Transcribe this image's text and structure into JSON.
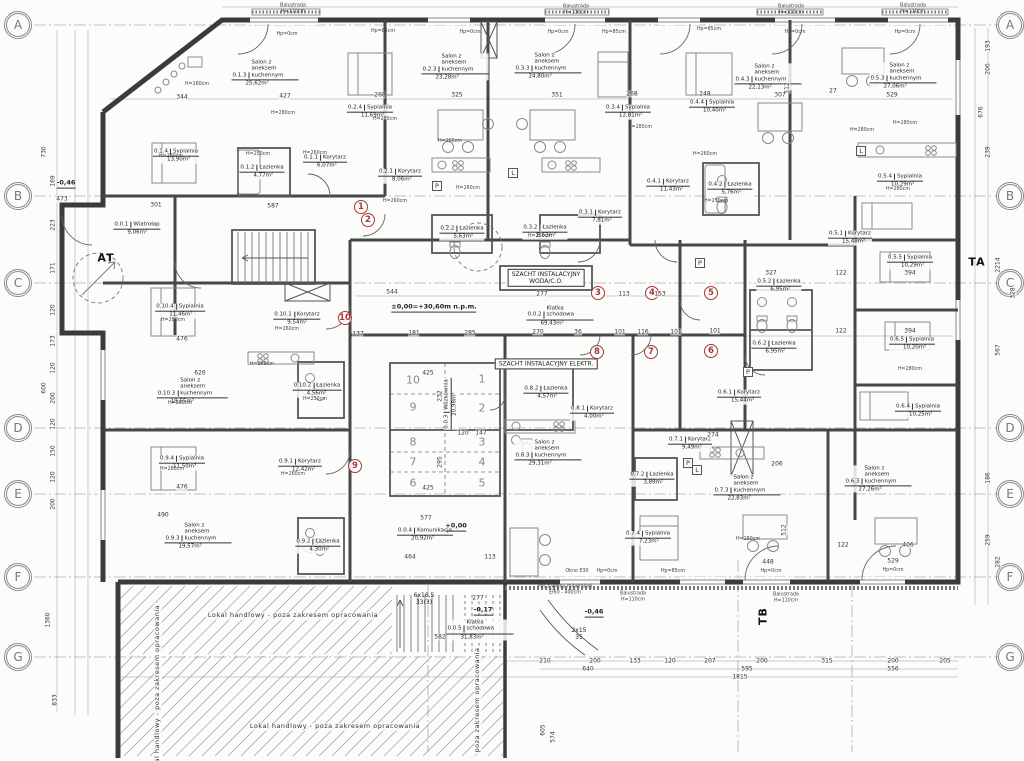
{
  "drawing": {
    "grid": {
      "letters": [
        "A",
        "B",
        "C",
        "D",
        "E",
        "F",
        "G"
      ],
      "ys": [
        25,
        196,
        283,
        428,
        494,
        577,
        657
      ],
      "left_x": 18,
      "right_x": 1010
    },
    "section_labels": [
      {
        "t": "TA",
        "x": 977,
        "y": 262,
        "rot": 0
      },
      {
        "t": "TB",
        "x": 763,
        "y": 616,
        "rot": 1
      },
      {
        "t": "AT",
        "x": 106,
        "y": 258,
        "rot": 0
      }
    ],
    "apartment_markers": [
      {
        "n": "1",
        "x": 361,
        "y": 207
      },
      {
        "n": "2",
        "x": 368,
        "y": 220
      },
      {
        "n": "3",
        "x": 598,
        "y": 293
      },
      {
        "n": "4",
        "x": 652,
        "y": 293
      },
      {
        "n": "5",
        "x": 711,
        "y": 293
      },
      {
        "n": "6",
        "x": 711,
        "y": 351
      },
      {
        "n": "7",
        "x": 651,
        "y": 352
      },
      {
        "n": "8",
        "x": 597,
        "y": 352
      },
      {
        "n": "9",
        "x": 355,
        "y": 466
      },
      {
        "n": "10",
        "x": 345,
        "y": 318
      }
    ],
    "storage_cells": [
      {
        "n": "10",
        "x": 413,
        "y": 380
      },
      {
        "n": "9",
        "x": 413,
        "y": 407
      },
      {
        "n": "8",
        "x": 413,
        "y": 442
      },
      {
        "n": "7",
        "x": 413,
        "y": 462
      },
      {
        "n": "6",
        "x": 413,
        "y": 483
      },
      {
        "n": "1",
        "x": 482,
        "y": 379
      },
      {
        "n": "2",
        "x": 482,
        "y": 408
      },
      {
        "n": "3",
        "x": 482,
        "y": 442
      },
      {
        "n": "4",
        "x": 482,
        "y": 462
      },
      {
        "n": "5",
        "x": 482,
        "y": 483
      }
    ],
    "rooms": [
      [
        "0.0.1",
        "Wiatrołap",
        "9,06m²",
        137,
        229
      ],
      [
        "0.0.2",
        "Klatka schodowa",
        "69,43m²",
        560,
        316
      ],
      [
        "0.0.3",
        "Wózkownia",
        "20,98m²",
        451,
        404
      ],
      [
        "0.0.4",
        "Komunikacja",
        "20,92m²",
        425,
        535
      ],
      [
        "0.0.5",
        "Klatka schodowa",
        "31,83m²",
        480,
        630
      ],
      [
        "0.1.1",
        "Korytarz",
        "6,07m²",
        325,
        162
      ],
      [
        "0.1.2",
        "Łazienka",
        "4,77m²",
        262,
        172
      ],
      [
        "0.1.3",
        "Salon z aneksem kuchennym",
        "25,62m²",
        265,
        73
      ],
      [
        "0.1.4",
        "Sypialnia",
        "13,90m²",
        176,
        156
      ],
      [
        "0.2.1",
        "Korytarz",
        "8,06m²",
        400,
        176
      ],
      [
        "0.2.2",
        "Łazienka",
        "5,63m²",
        462,
        233
      ],
      [
        "0.2.3",
        "Salon z aneksem kuchennym",
        "23,28m²",
        455,
        67
      ],
      [
        "0.2.4",
        "Sypialnia",
        "11,69m²",
        370,
        112
      ],
      [
        "0.3.1",
        "Korytarz",
        "7,81m²",
        600,
        217
      ],
      [
        "0.3.2",
        "Łazienka",
        "5,63m²",
        545,
        232
      ],
      [
        "0.3.3",
        "Salon z aneksem kuchennym",
        "24,80m²",
        548,
        66
      ],
      [
        "0.3.4",
        "Sypialnia",
        "12,81m²",
        628,
        112
      ],
      [
        "0.4.1",
        "Korytarz",
        "11,43m²",
        668,
        186
      ],
      [
        "0.4.2",
        "Łazienka",
        "5,76m²",
        730,
        189
      ],
      [
        "0.4.3",
        "Salon z aneksem kuchennym",
        "22,13m²",
        768,
        77
      ],
      [
        "0.4.4",
        "Sypialnia",
        "10,40m²",
        712,
        107
      ],
      [
        "0.5.1",
        "Korytarz",
        "15,48m²",
        850,
        238
      ],
      [
        "0.5.2",
        "Łazienka",
        "6,95m²",
        779,
        286
      ],
      [
        "0.5.3",
        "Salon z aneksem kuchennym",
        "27,06m²",
        903,
        76
      ],
      [
        "0.5.4",
        "Sypialnia",
        "10,29m²",
        900,
        181
      ],
      [
        "0.5.5",
        "Sypialnia",
        "10,29m²",
        910,
        262
      ],
      [
        "0.6.1",
        "Korytarz",
        "15,44m²",
        739,
        397
      ],
      [
        "0.6.2",
        "Łazienka",
        "6,95m²",
        774,
        348
      ],
      [
        "0.6.3",
        "Salon z aneksem kuchennym",
        "27,26m²",
        878,
        479
      ],
      [
        "0.6.4",
        "Sypialnia",
        "10,25m²",
        918,
        411
      ],
      [
        "0.6.5",
        "Sypialnia",
        "10,20m²",
        912,
        344
      ],
      [
        "0.7.1",
        "Korytarz",
        "9,49m²",
        690,
        444
      ],
      [
        "0.7.2",
        "Łazienka",
        "3,89m²",
        652,
        479
      ],
      [
        "0.7.3",
        "Salon z aneksem kuchennym",
        "22,83m²",
        747,
        488
      ],
      [
        "0.7.4",
        "Sypialnia",
        "7,23m²",
        648,
        538
      ],
      [
        "0.8.1",
        "Korytarz",
        "4,00m²",
        592,
        413
      ],
      [
        "0.8.2",
        "Łazienka",
        "4,57m²",
        546,
        393
      ],
      [
        "0.8.3",
        "Salon z aneksem kuchennym",
        "29,31m²",
        548,
        453
      ],
      [
        "0.9.1",
        "Korytarz",
        "12,42m²",
        300,
        466
      ],
      [
        "0.9.2",
        "Łazienka",
        "4,30m²",
        318,
        546
      ],
      [
        "0.9.3",
        "Salon z aneksem kuchennym",
        "19,57m²",
        198,
        536
      ],
      [
        "0.9.4",
        "Sypialnia",
        "11,50m²",
        182,
        463
      ],
      [
        "0.10.1",
        "Korytarz",
        "9,54m²",
        297,
        319
      ],
      [
        "0.10.2",
        "Łazienka",
        "4,56m²",
        317,
        390
      ],
      [
        "0.10.3",
        "Salon z aneksem kuchennym",
        "19,55m²",
        192,
        391
      ],
      [
        "0.10.4",
        "Sypialnia",
        "11,46m²",
        180,
        311
      ]
    ],
    "annotations": [
      [
        "SZACHT INSTALACYJNY\nWODA/C.O.",
        546,
        278,
        "boxed",
        0
      ],
      [
        "SZACHT INSTALACYJNY ELEKTR.",
        546,
        364,
        "boxed",
        0
      ],
      [
        "±0,00=+30,60m n.p.m.",
        434,
        308,
        "lvl",
        0
      ],
      [
        "+0,00",
        456,
        527,
        "lvl",
        0
      ],
      [
        "-0,17",
        483,
        611,
        "lvl",
        0
      ],
      [
        "-0,46",
        594,
        613,
        "lvl",
        0
      ],
      [
        "-0,46",
        66,
        184,
        "lvl",
        0
      ],
      [
        "6x16,5\n33(3)",
        424,
        599,
        "ann",
        0
      ],
      [
        "2x15\n35",
        579,
        634,
        "ann",
        0
      ],
      [
        "Okno E30",
        577,
        572,
        "tiny",
        0
      ],
      [
        "Pas z wełny mineralnej\nEI60 - 400cm",
        565,
        590,
        "tiny",
        0
      ],
      [
        "Balustrada\nH=110cm",
        293,
        9,
        "tiny",
        0
      ],
      [
        "Balustrada\nH=110cm",
        576,
        10,
        "tiny",
        0
      ],
      [
        "Balustrada\nH=110cm",
        791,
        10,
        "tiny",
        0
      ],
      [
        "Balustrada\nH=110cm",
        913,
        9,
        "tiny",
        0
      ],
      [
        "Balustrada\nH=110cm",
        633,
        597,
        "tiny",
        0
      ],
      [
        "Balustrada\nH=110cm",
        786,
        598,
        "tiny",
        0
      ],
      [
        "Lokal handlowy - poza zakresem opracowania",
        293,
        616,
        "lokal",
        0
      ],
      [
        "Lokal handlowy - poza zakresem opracowania",
        335,
        727,
        "lokal",
        0
      ],
      [
        "Lokal handlowy - poza zakresem opracowania",
        158,
        690,
        "lokal",
        1
      ],
      [
        "poza zakresem opracowania",
        478,
        700,
        "lokal",
        1
      ],
      [
        "Hp=0cm",
        287,
        35,
        "tiny",
        0
      ],
      [
        "Hp=0cm",
        470,
        33,
        "tiny",
        0
      ],
      [
        "Hp=0cm",
        558,
        33,
        "tiny",
        0
      ],
      [
        "Hp=0cm",
        795,
        33,
        "tiny",
        0
      ],
      [
        "Hp=0cm",
        905,
        33,
        "tiny",
        0
      ],
      [
        "Hp=0cm",
        607,
        572,
        "tiny",
        0
      ],
      [
        "Hp=0cm",
        771,
        572,
        "tiny",
        0
      ],
      [
        "Hp=0cm",
        893,
        571,
        "tiny",
        0
      ],
      [
        "Hp=85cm",
        383,
        32,
        "tiny",
        0
      ],
      [
        "Hp=85cm",
        614,
        33,
        "tiny",
        0
      ],
      [
        "Hp=85cm",
        709,
        30,
        "tiny",
        0
      ],
      [
        "Hp=85cm",
        673,
        572,
        "tiny",
        0
      ],
      [
        "H=260cm",
        197,
        85,
        "tiny",
        0
      ],
      [
        "H=260cm",
        315,
        154,
        "tiny",
        0
      ],
      [
        "H=260cm",
        450,
        142,
        "tiny",
        0
      ],
      [
        "H=260cm",
        395,
        202,
        "tiny",
        0
      ],
      [
        "H=260cm",
        705,
        155,
        "tiny",
        0
      ],
      [
        "H=260cm",
        287,
        330,
        "tiny",
        0
      ],
      [
        "H=260cm",
        262,
        365,
        "tiny",
        0
      ],
      [
        "H=260cm",
        293,
        475,
        "tiny",
        0
      ],
      [
        "H=260cm",
        468,
        189,
        "tiny",
        0
      ],
      [
        "H=280cm",
        283,
        114,
        "tiny",
        0
      ],
      [
        "H=280cm",
        171,
        157,
        "tiny",
        0
      ],
      [
        "H=280cm",
        385,
        120,
        "tiny",
        0
      ],
      [
        "H=280cm",
        640,
        128,
        "tiny",
        0
      ],
      [
        "H=280cm",
        905,
        124,
        "tiny",
        0
      ],
      [
        "H=280cm",
        898,
        190,
        "tiny",
        0
      ],
      [
        "H=280cm",
        173,
        321,
        "tiny",
        0
      ],
      [
        "H=280cm",
        180,
        404,
        "tiny",
        0
      ],
      [
        "H=280cm",
        172,
        470,
        "tiny",
        0
      ],
      [
        "H=280cm",
        862,
        131,
        "tiny",
        0
      ],
      [
        "H=280cm",
        748,
        540,
        "tiny",
        0
      ],
      [
        "H=280cm",
        910,
        370,
        "tiny",
        0
      ],
      [
        "H=250cm",
        258,
        155,
        "tiny",
        0
      ],
      [
        "H=250cm",
        540,
        237,
        "tiny",
        0
      ],
      [
        "H=250cm",
        716,
        202,
        "tiny",
        0
      ],
      [
        "H=250cm",
        315,
        400,
        "tiny",
        0
      ]
    ],
    "fixture_marks": {
      "p_squares": [
        [
          437,
          186
        ],
        [
          700,
          263
        ],
        [
          688,
          463
        ],
        [
          748,
          372
        ]
      ],
      "l_squares": [
        [
          513,
          173
        ],
        [
          861,
          151
        ],
        [
          697,
          470
        ]
      ],
      "p_label": "P",
      "l_label": "L"
    },
    "dimensions": [
      [
        344,
        182,
        97,
        0
      ],
      [
        427,
        285,
        96,
        0
      ],
      [
        268,
        380,
        95,
        0
      ],
      [
        325,
        457,
        95,
        0
      ],
      [
        351,
        557,
        95,
        0
      ],
      [
        268,
        632,
        94,
        0
      ],
      [
        248,
        705,
        94,
        0
      ],
      [
        307,
        780,
        95,
        0
      ],
      [
        27,
        833,
        91,
        0
      ],
      [
        529,
        892,
        95,
        0
      ],
      [
        473,
        62,
        199,
        0
      ],
      [
        301,
        156,
        205,
        0
      ],
      [
        587,
        273,
        206,
        0
      ],
      [
        544,
        392,
        292,
        0
      ],
      [
        277,
        542,
        294,
        0
      ],
      [
        113,
        624,
        294,
        0
      ],
      [
        153,
        660,
        294,
        0
      ],
      [
        270,
        538,
        332,
        0
      ],
      [
        36,
        578,
        332,
        0
      ],
      [
        101,
        620,
        332,
        0
      ],
      [
        116,
        643,
        332,
        0
      ],
      [
        101,
        676,
        332,
        0
      ],
      [
        137,
        358,
        334,
        0
      ],
      [
        181,
        414,
        333,
        0
      ],
      [
        285,
        470,
        333,
        0
      ],
      [
        327,
        771,
        273,
        0
      ],
      [
        122,
        841,
        273,
        0
      ],
      [
        394,
        910,
        273,
        0
      ],
      [
        101,
        715,
        331,
        0
      ],
      [
        122,
        841,
        331,
        0
      ],
      [
        394,
        910,
        331,
        0
      ],
      [
        274,
        713,
        435,
        0
      ],
      [
        206,
        777,
        464,
        0
      ],
      [
        122,
        843,
        545,
        0
      ],
      [
        406,
        908,
        545,
        0
      ],
      [
        476,
        182,
        339,
        0
      ],
      [
        626,
        200,
        373,
        0
      ],
      [
        476,
        182,
        487,
        0
      ],
      [
        490,
        163,
        515,
        0
      ],
      [
        577,
        426,
        518,
        0
      ],
      [
        464,
        410,
        557,
        0
      ],
      [
        113,
        490,
        557,
        0
      ],
      [
        277,
        478,
        598,
        0
      ],
      [
        582,
        440,
        637,
        0
      ],
      [
        448,
        768,
        562,
        0
      ],
      [
        529,
        893,
        561,
        0
      ],
      [
        210,
        545,
        661,
        0
      ],
      [
        200,
        595,
        661,
        0
      ],
      [
        133,
        635,
        661,
        0
      ],
      [
        120,
        670,
        661,
        0
      ],
      [
        207,
        710,
        661,
        0
      ],
      [
        200,
        762,
        661,
        0
      ],
      [
        315,
        827,
        661,
        0
      ],
      [
        200,
        893,
        661,
        0
      ],
      [
        205,
        945,
        661,
        0
      ],
      [
        640,
        588,
        669,
        0
      ],
      [
        595,
        747,
        669,
        0
      ],
      [
        556,
        893,
        669,
        0
      ],
      [
        1815,
        740,
        677,
        0
      ],
      [
        730,
        44,
        152,
        1
      ],
      [
        169,
        53,
        181,
        1
      ],
      [
        223,
        53,
        225,
        1
      ],
      [
        171,
        53,
        268,
        1
      ],
      [
        120,
        53,
        310,
        1
      ],
      [
        173,
        53,
        341,
        1
      ],
      [
        120,
        53,
        368,
        1
      ],
      [
        200,
        53,
        398,
        1
      ],
      [
        120,
        53,
        424,
        1
      ],
      [
        150,
        53,
        451,
        1
      ],
      [
        120,
        53,
        477,
        1
      ],
      [
        200,
        53,
        504,
        1
      ],
      [
        600,
        44,
        388,
        1
      ],
      [
        1360,
        48,
        620,
        1
      ],
      [
        833,
        55,
        700,
        1
      ],
      [
        193,
        988,
        46,
        1
      ],
      [
        200,
        988,
        69,
        1
      ],
      [
        676,
        981,
        112,
        1
      ],
      [
        239,
        988,
        152,
        1
      ],
      [
        2214,
        998,
        265,
        1
      ],
      [
        328,
        1013,
        293,
        1
      ],
      [
        567,
        998,
        350,
        1
      ],
      [
        186,
        988,
        478,
        1
      ],
      [
        259,
        988,
        540,
        1
      ],
      [
        282,
        998,
        562,
        1
      ],
      [
        512,
        787,
        88,
        1
      ],
      [
        512,
        784,
        530,
        1
      ],
      [
        605,
        543,
        730,
        1
      ],
      [
        574,
        553,
        737,
        1
      ],
      [
        232,
        440,
        396,
        1
      ],
      [
        295,
        440,
        462,
        1
      ],
      [
        425,
        428,
        373,
        0
      ],
      [
        425,
        428,
        488,
        0
      ],
      [
        120,
        463,
        433,
        0
      ],
      [
        147,
        481,
        433,
        0
      ]
    ]
  }
}
